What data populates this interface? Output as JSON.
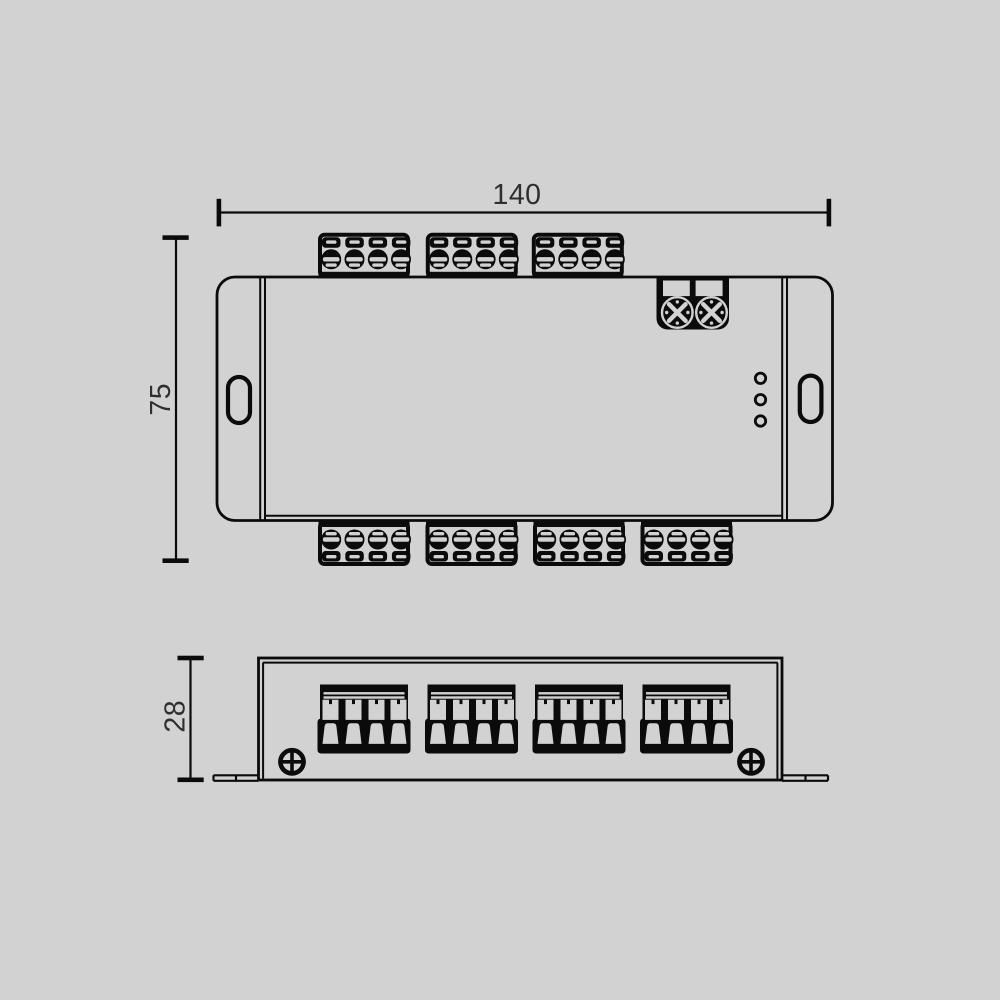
{
  "meta": {
    "drawing_type": "technical dimension drawing, two orthographic views of terminal controller unit",
    "background_color": "#d2d2d2",
    "line_color": "#0b0b0b",
    "text_color": "#2f2f2f"
  },
  "dimensions": {
    "width_label": "140",
    "height_label": "75",
    "depth_label": "28"
  },
  "top_view": {
    "top_terminal_blocks": 3,
    "bottom_terminal_blocks": 4,
    "terminals_per_block": 4,
    "power_screw_terminals": 2,
    "led_indicators": 3,
    "mounting_slots": 2
  },
  "front_view": {
    "wire_connectors": 4,
    "mounting_screws": 2,
    "mounting_flanges": 2
  }
}
